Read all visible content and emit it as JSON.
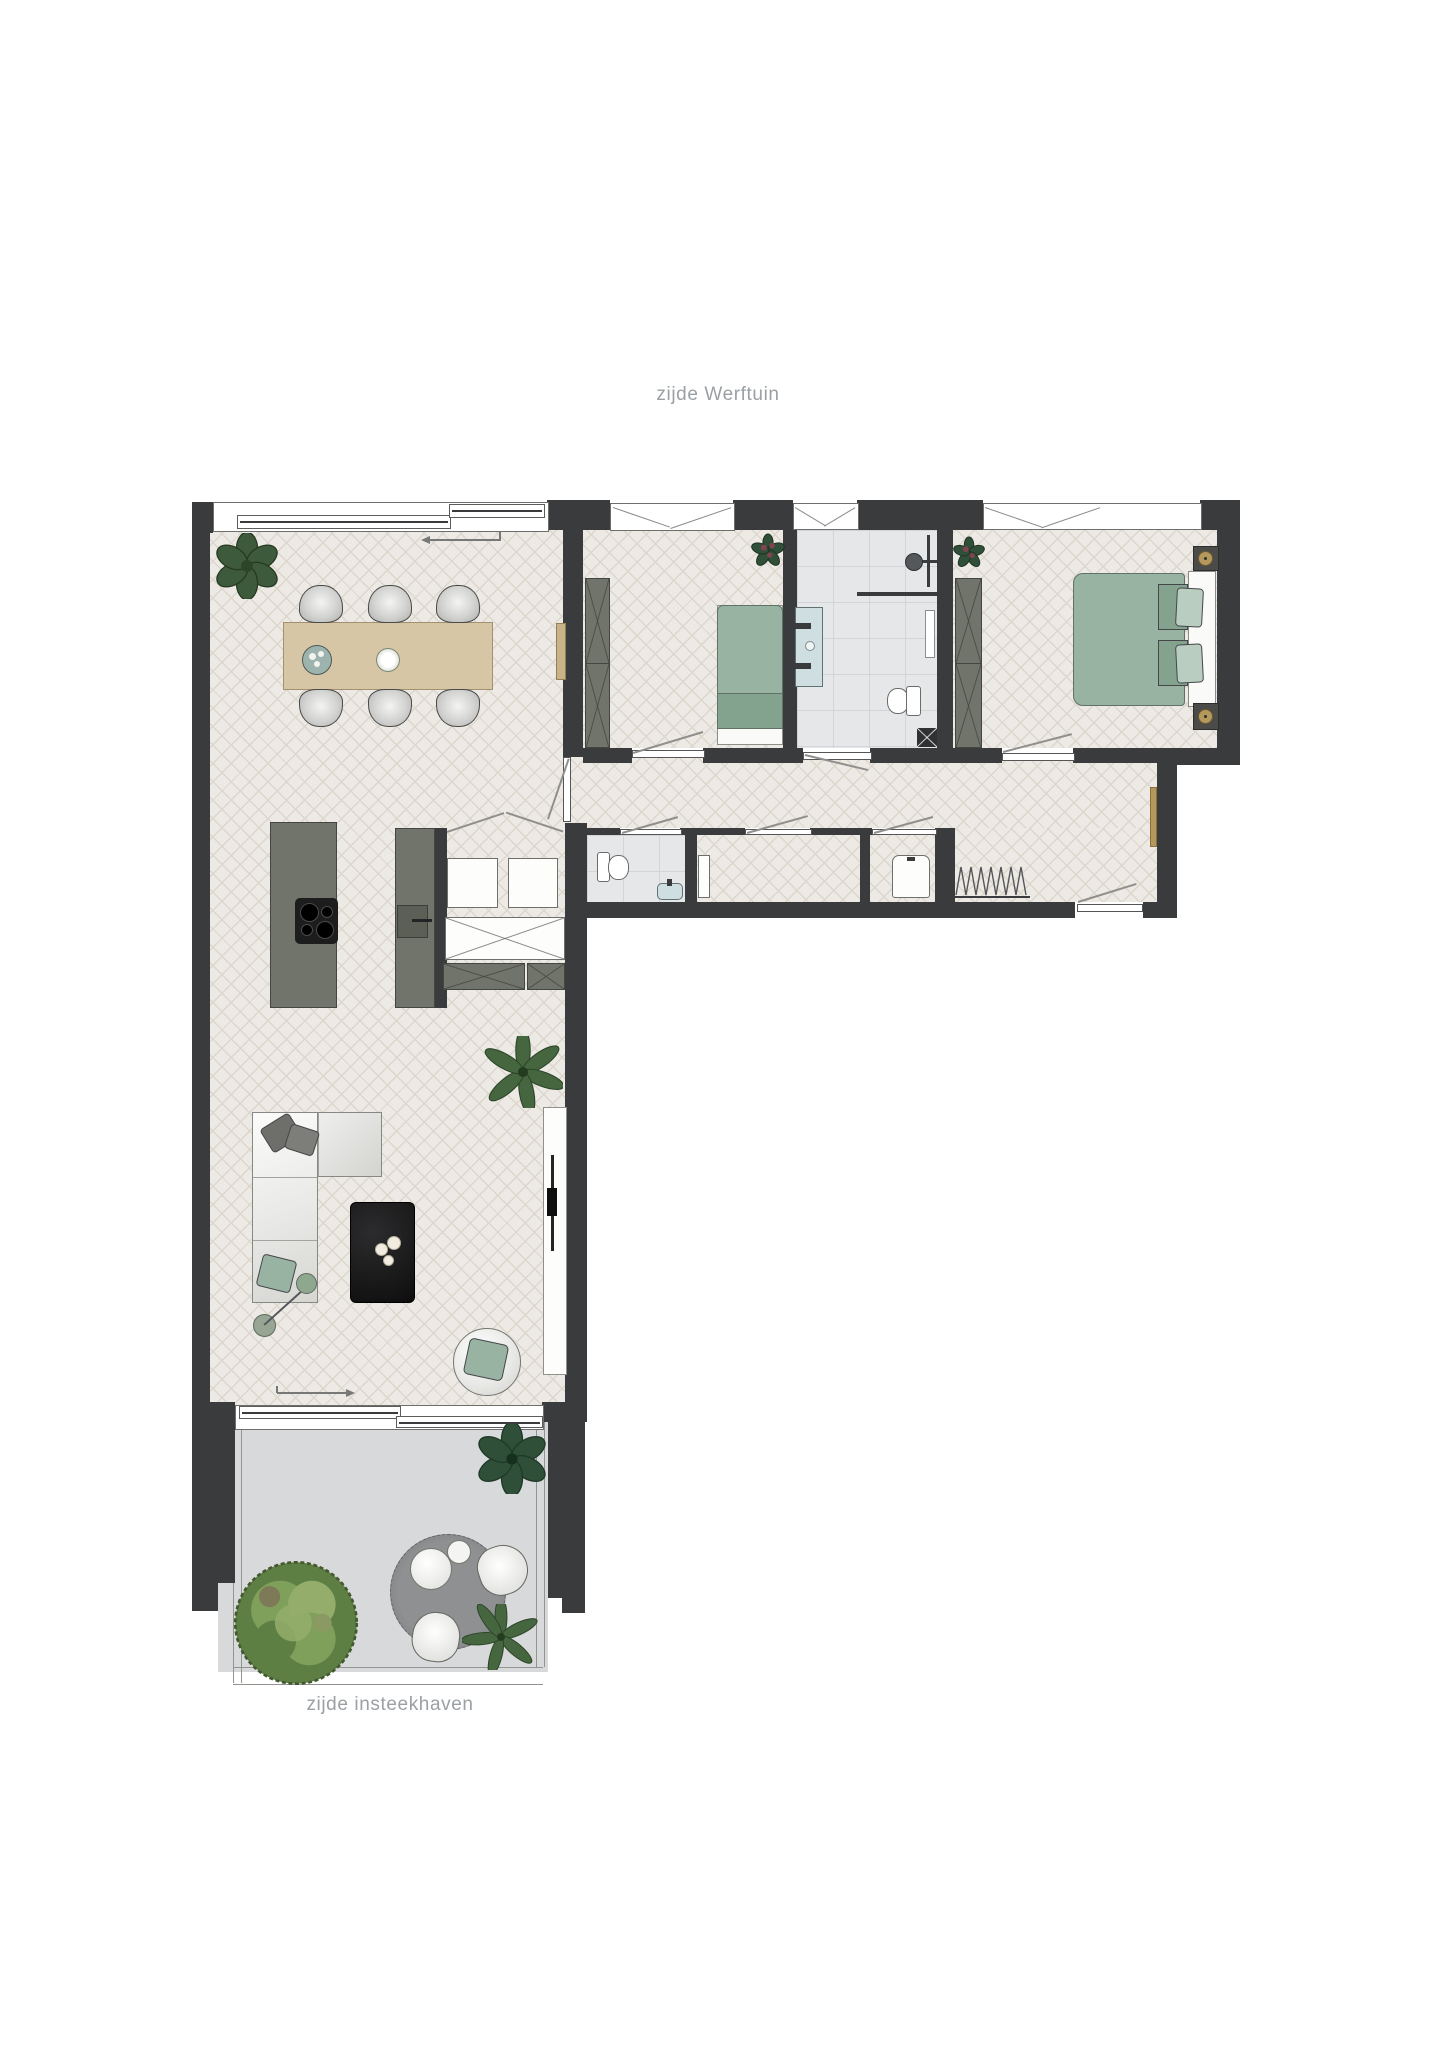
{
  "labels": {
    "side_top": "zijde Werftuin",
    "side_bottom": "zijde insteekhaven"
  },
  "colors": {
    "wall": "#3a3b3d",
    "floorWood": "#edeae5",
    "floorWoodLine": "#dcd6cc",
    "tile": "#e6e7e9",
    "tileLine": "#d2d4d7",
    "terraceFloor": "#d8d9da",
    "cabinet": "#70746a",
    "cabinetDark": "#5b5f55",
    "cabinetLine": "#44473f",
    "bedGreen": "#98b3a2",
    "bedGreenDark": "#83a38f",
    "pillowGreen": "#b9cec1",
    "wood": "#d7c6a5",
    "woodLine": "#a3906e",
    "brass": "#b5985c",
    "tvBlack": "#1d1d1e",
    "sanitaryBlue": "#cfdfe1",
    "rugGray": "#86888b",
    "plantGreen": "#46663f",
    "plantDark": "#2f4f38",
    "bushGreen": "#7fa05b",
    "bushDark": "#5d7f44",
    "bushLight": "#94ad6b",
    "bloomRed": "#7e4450",
    "textGray": "#9aa0a3",
    "doorLine": "#8f8f8c",
    "white": "#ffffff"
  },
  "depicts": {
    "type": "apartment-floorplan",
    "rooms": [
      "living-dining-kitchen",
      "bedroom-1",
      "bathroom",
      "bedroom-2",
      "hallway",
      "toilet",
      "storage-closet",
      "tech-room",
      "terrace"
    ]
  }
}
